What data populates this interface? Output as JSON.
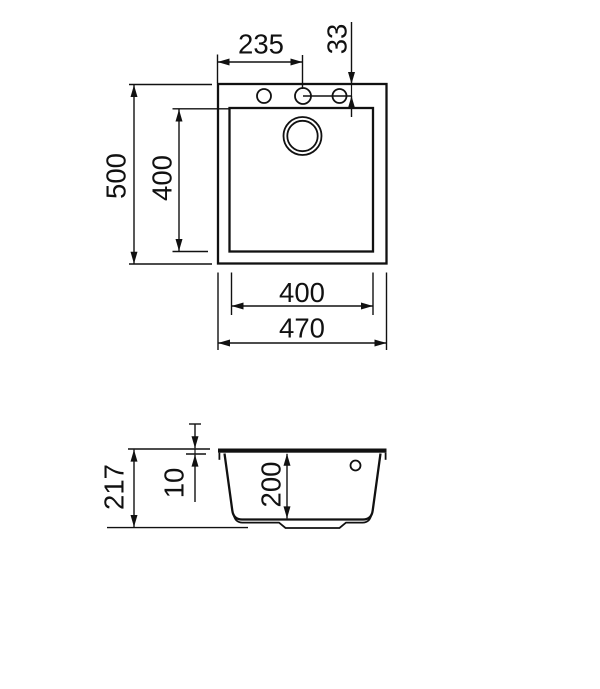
{
  "drawing": {
    "background_color": "#ffffff",
    "line_color": "#111111",
    "views": {
      "top": {
        "dims": {
          "faucet_offset_x": "235",
          "faucet_offset_y": "33",
          "overall_depth": "500",
          "bowl_depth": "400",
          "bowl_width": "400",
          "overall_width": "470"
        }
      },
      "side": {
        "dims": {
          "overall_height": "217",
          "rim_thickness": "10",
          "bowl_height": "200"
        }
      }
    }
  }
}
